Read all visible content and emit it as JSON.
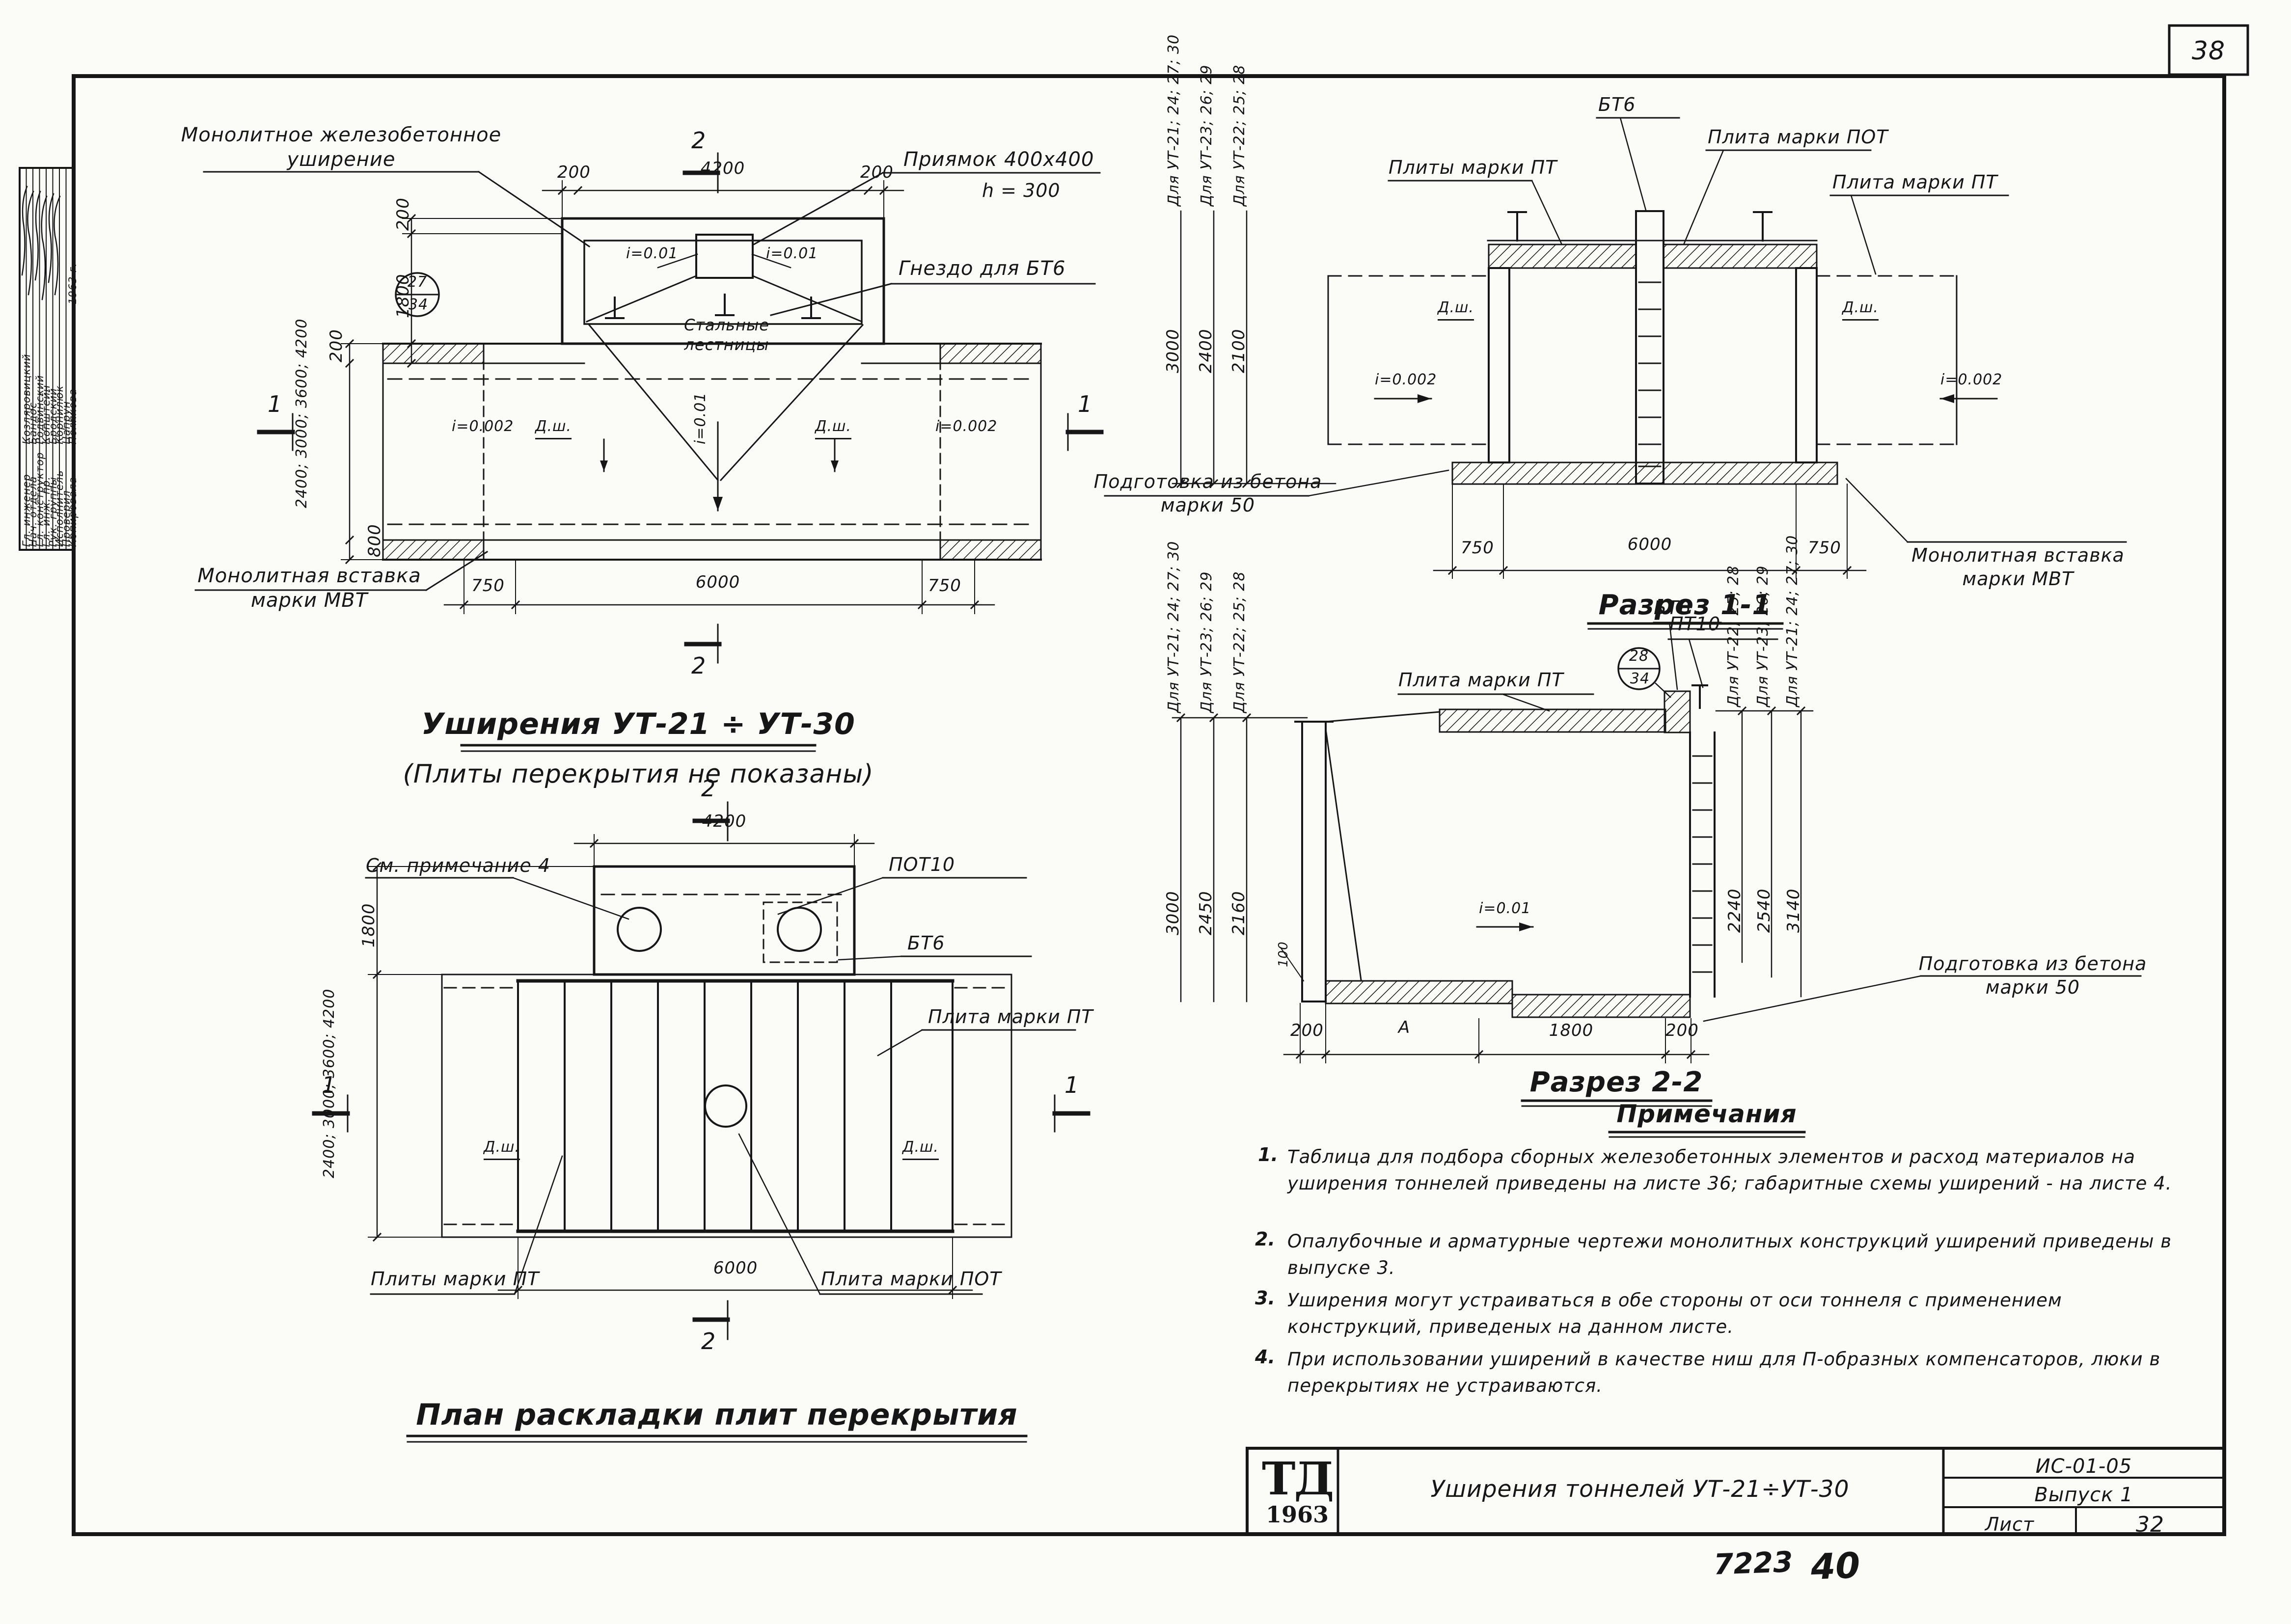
{
  "page": {
    "number": "38",
    "handwritten_code": "7223",
    "handwritten_num": "40"
  },
  "stamp": {
    "rows": [
      {
        "role": "Гл. инженер",
        "name": "Козляровицкий"
      },
      {
        "role": "Нач. отдела",
        "name": "Бандос"
      },
      {
        "role": "Гл. конструктор",
        "name": "Родвинский"
      },
      {
        "role": "Гл. инж. пр.",
        "name": "Копштейн"
      },
      {
        "role": "Рук. группы",
        "name": "Бродский"
      },
      {
        "role": "Исполнитель",
        "name": "Корнилюк"
      },
      {
        "role": "Проверил",
        "name": "Цапрун"
      },
      {
        "role": "Копировала",
        "name": "Полякова"
      }
    ],
    "year": "1963 г."
  },
  "plan1": {
    "callout_monolithic": "Монолитное  железобетонное\nуширение",
    "callout_pit": "Приямок 400x400",
    "callout_pit_h": "h = 300",
    "callout_socket": "Гнездо для БТ6",
    "label_stairs": "Стальные\nлестницы",
    "slope_pit_left": "i=0.01",
    "slope_pit_right": "i=0.01",
    "slope_axis": "i=0.01",
    "slope_tunnel_left": "i=0.002",
    "slope_tunnel_right": "i=0.002",
    "dsh_left": "Д.ш.",
    "dsh_right": "Д.ш.",
    "ref_top": "27",
    "ref_bottom": "34",
    "callout_insert": "Монолитная вставка\nмарки МВТ",
    "dim_top_left": "200",
    "dim_top_mid": "4200",
    "dim_top_right": "200",
    "dim_left_1": "200",
    "dim_left_2": "1800",
    "dim_left_3": "200",
    "dim_widths": "2400; 3000;\n3600; 4200",
    "dim_left_4": "800",
    "dim_bot_left": "750",
    "dim_bot_mid": "6000",
    "dim_bot_right": "750",
    "marker_top": "2",
    "marker_bottom": "2",
    "marker_left": "1",
    "marker_right": "1",
    "title": "Уширения  УТ-21 ÷ УТ-30",
    "subtitle": "(Плиты перекрытия не показаны)"
  },
  "plan2": {
    "callout_note": "См. примечание 4",
    "callout_pot10": "ПОТ10",
    "callout_bt6": "БТ6",
    "callout_pt": "Плита марки ПТ",
    "dsh_left": "Д.ш.",
    "dsh_right": "Д.ш.",
    "dim_top": "4200",
    "dim_bottom": "6000",
    "dim_left_1": "1800",
    "dim_widths": "2400; 3000;\n3600; 4200",
    "callout_pt_bottom": "Плиты марки ПТ",
    "callout_pot_bottom": "Плита марки ПОТ",
    "marker_top": "2",
    "marker_bottom": "2",
    "marker_left": "1",
    "marker_right": "1",
    "title": "План раскладки плит перекрытия"
  },
  "section1": {
    "for_a": "Для УТ-21; 24; 27; 30",
    "for_b": "Для УТ-23; 26; 29",
    "for_c": "Для УТ-22; 25; 28",
    "dim_a": "3000",
    "dim_b": "2400",
    "dim_c": "2100",
    "callout_pt_left": "Плиты марки ПТ",
    "callout_bt6": "БТ6",
    "callout_pot": "Плита марки ПОТ",
    "callout_pt_right": "Плита марки ПТ",
    "dsh_left": "Д.ш.",
    "dsh_right": "Д.ш.",
    "slope_left": "i=0.002",
    "slope_right": "i=0.002",
    "callout_prep": "Подготовка из бетона\nмарки 50",
    "callout_insert": "Монолитная вставка\nмарки МВТ",
    "dim_bot_left": "750",
    "dim_bot_mid": "6000",
    "dim_bot_right": "750",
    "title": "Разрез 1-1"
  },
  "section2": {
    "for_a": "Для УТ-21; 24; 27; 30",
    "for_b": "Для УТ-23; 26; 29",
    "for_c": "Для УТ-22; 25; 28",
    "dim_a": "3000",
    "dim_b": "2450",
    "dim_c": "2160",
    "for_d": "Для УТ-22; 25; 28",
    "for_e": "Для УТ-23; 26; 29",
    "for_f": "Для УТ-21; 24; 27; 30",
    "dim_d": "2240",
    "dim_e": "2540",
    "dim_f": "3140",
    "callout_pt": "Плита марки ПТ",
    "callout_bt6": "БТ6",
    "callout_pt10": "ПТ10",
    "ref_top": "28",
    "ref_bottom": "34",
    "slope": "i=0.01",
    "dim_100": "100",
    "dim_bot_1": "200",
    "dim_bot_2": "А",
    "dim_bot_3": "1800",
    "dim_bot_4": "200",
    "callout_prep": "Подготовка из бетона\nмарки 50",
    "title": "Разрез 2-2"
  },
  "notes": {
    "heading": "Примечания",
    "items": [
      {
        "num": "1.",
        "text": "Таблица для подбора сборных железобетонных элементов и расход материалов на уширения тоннелей приведены на листе 36; габаритные схемы уширений - на листе 4."
      },
      {
        "num": "2.",
        "text": "Опалубочные и арматурные чертежи монолитных конструкций уширений приведены в выпуске 3."
      },
      {
        "num": "3.",
        "text": "Уширения могут устраиваться в обе стороны от оси тоннеля с применением конструкций, приведеных на данном листе."
      },
      {
        "num": "4.",
        "text": "При использовании уширений в качестве ниш для П-образных компенсаторов, люки в перекрытиях не устраиваются."
      }
    ]
  },
  "titleblock": {
    "logo_top": "ТД",
    "logo_year": "1963",
    "title": "Уширения тоннелей УТ-21÷УТ-30",
    "code": "ИС-01-05",
    "issue": "Выпуск 1",
    "sheet_label": "Лист",
    "sheet_number": "32"
  }
}
